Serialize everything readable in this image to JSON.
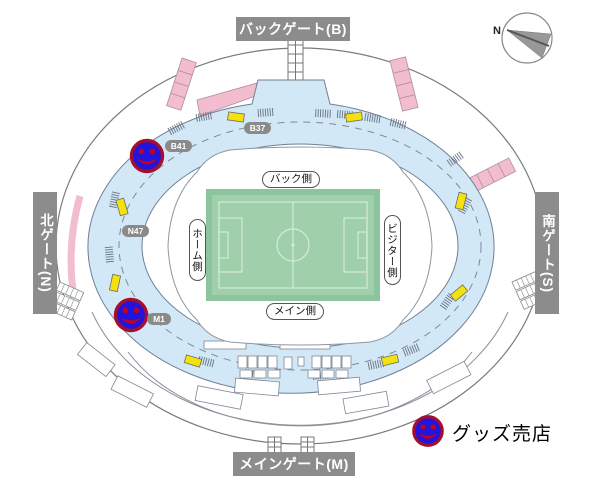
{
  "gates": {
    "back": "バックゲート(B)",
    "north": "北ゲート(N)",
    "south": "南ゲート(S)",
    "main": "メインゲート(M)"
  },
  "stand_sides": {
    "back": "バック側",
    "home": "ホーム側",
    "visitor": "ビジター側",
    "main": "メイン側"
  },
  "markers": {
    "b37": "B37",
    "b41": "B41",
    "n47": "N47",
    "m1": "M1"
  },
  "legend": {
    "goods_shop": "グッズ売店"
  },
  "compass": {
    "north": "N"
  },
  "goods_shop_locations": [
    "B41",
    "M1"
  ],
  "colors": {
    "concourse": "#d3e8f6",
    "pitch": "#9fd0ab",
    "pitch_border": "#8cc49e",
    "pitch_lines": "#d4ead9",
    "gate_label_bg": "#8c8c8c",
    "marker_bg": "#8a8a8a",
    "kiosk": "#f4e20c",
    "ramp": "#f3bdd0",
    "shop_blue": "#2414d9",
    "shop_ring": "#a50f2d",
    "shop_face": "#c3001e"
  }
}
